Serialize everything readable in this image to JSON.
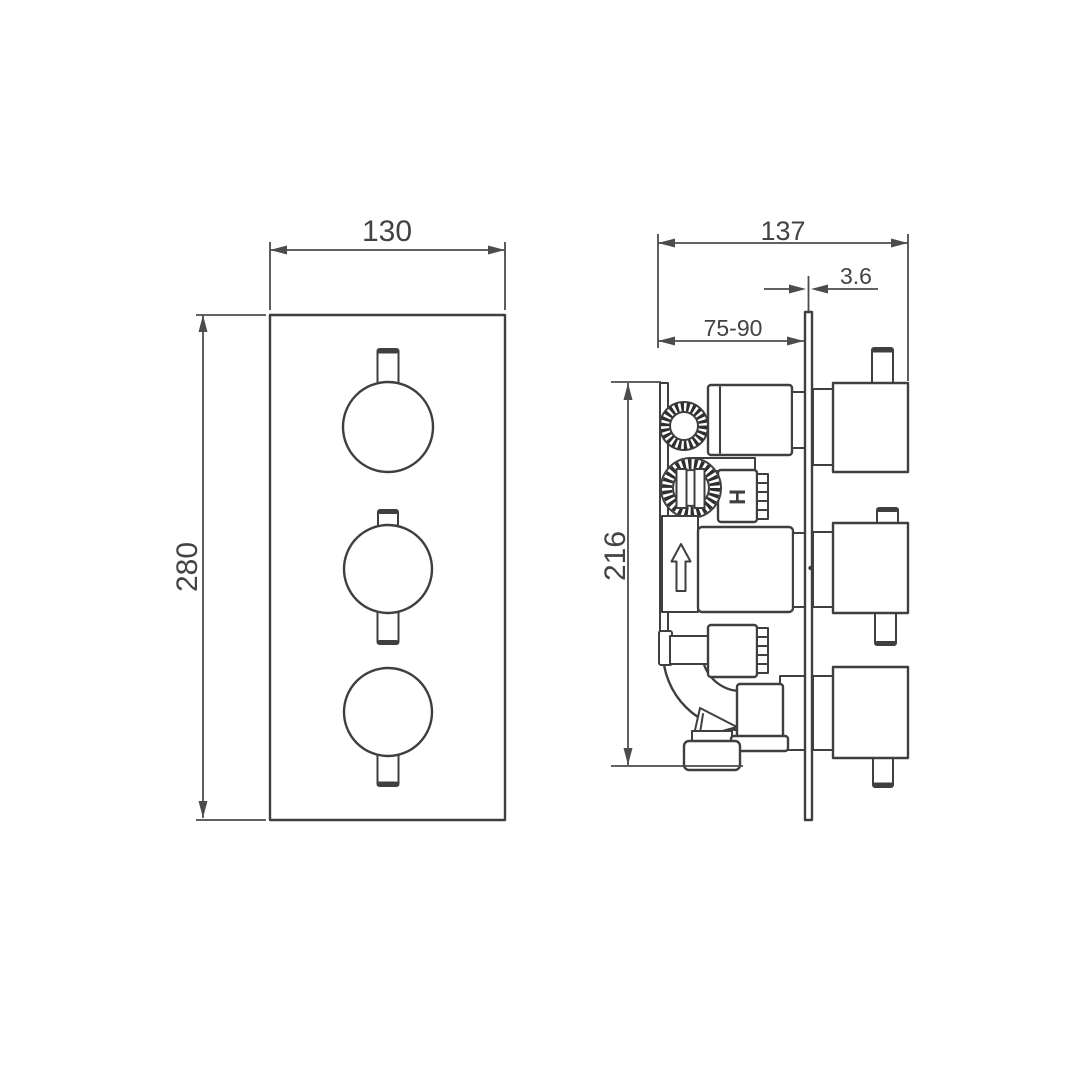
{
  "drawing": {
    "type": "technical-dimension-drawing",
    "views": {
      "front": {
        "width": "130",
        "height": "280"
      },
      "side": {
        "depth": "137",
        "plate_thickness": "3.6",
        "recess_depth_range": "75-90",
        "body_height": "216",
        "port_marking": "H"
      }
    },
    "colors": {
      "background": "#ffffff",
      "line": "#3f3f3f",
      "dimension": "#4c4c4c",
      "text": "#434343"
    }
  }
}
